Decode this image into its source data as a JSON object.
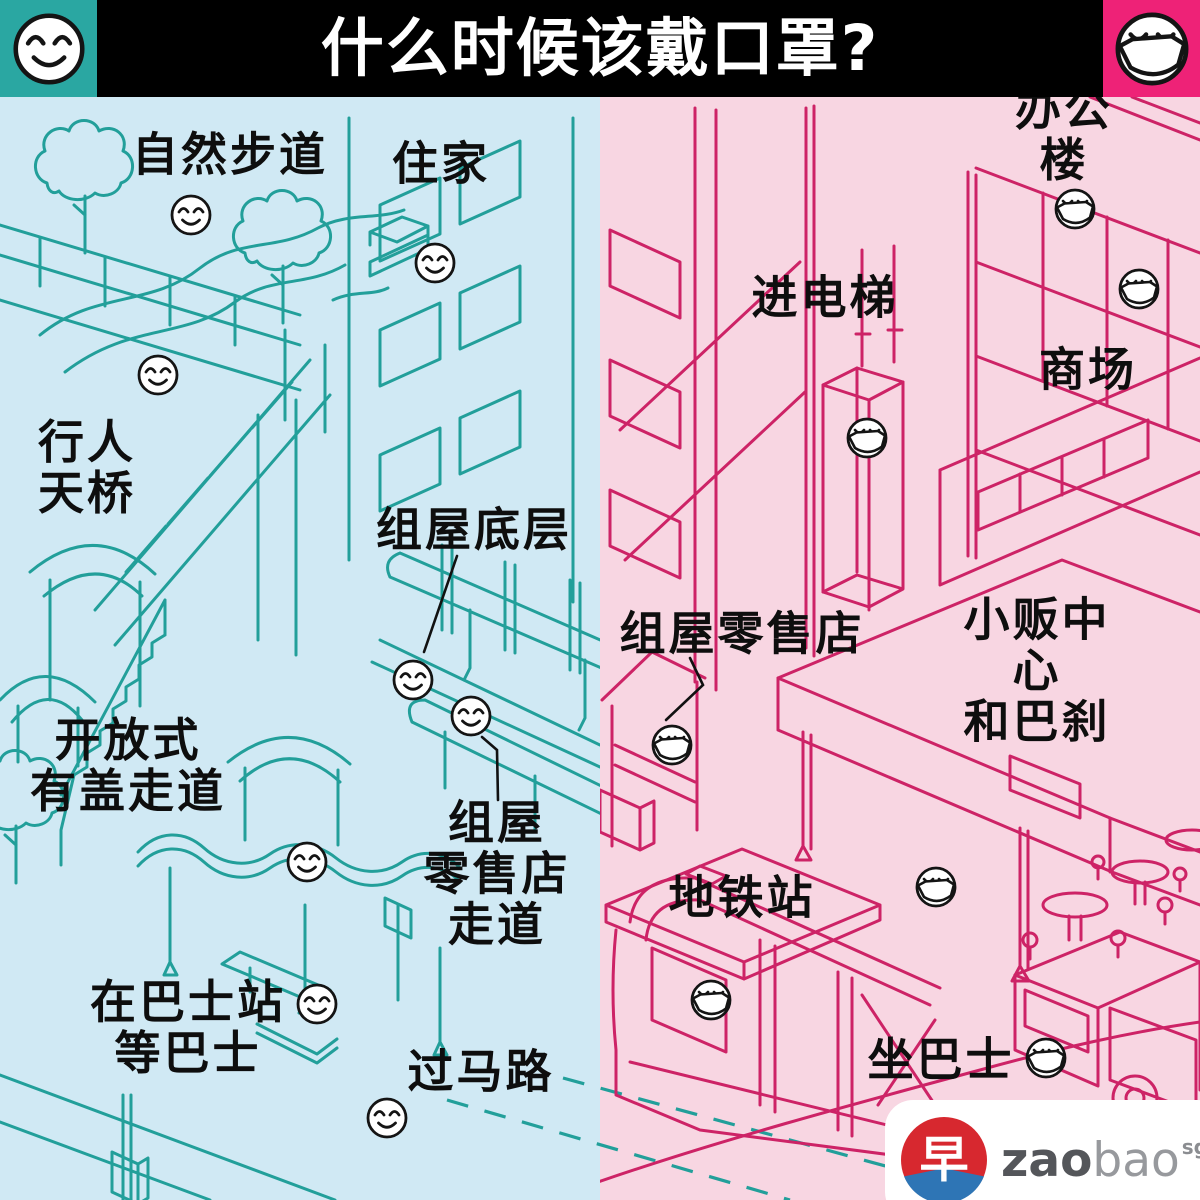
{
  "header": {
    "title": "什么时候该戴口罩?",
    "bar_color": "#000000",
    "left_badge": {
      "icon": "smiley-no-mask-icon",
      "color": "#2aa7a2"
    },
    "right_badge": {
      "icon": "smiley-mask-icon",
      "color": "#ee2277"
    }
  },
  "left_side": {
    "meaning": "no-mask-needed",
    "background": "#d0e9f4",
    "line_color": "#229f9a",
    "face_icon": "smiley-no-mask-icon",
    "face_count": 8,
    "labels": [
      {
        "id": "nature-trail",
        "text": "自然步道"
      },
      {
        "id": "home",
        "text": "住家"
      },
      {
        "id": "pedestrian-bridge",
        "text": "行人\n天桥"
      },
      {
        "id": "hdb-void-deck",
        "text": "组屋底层"
      },
      {
        "id": "open-covered-walkway",
        "text": "开放式\n有盖走道"
      },
      {
        "id": "hdb-shop-walkway",
        "text": "组屋\n零售店\n走道"
      },
      {
        "id": "wait-bus-at-stop",
        "text": "在巴士站\n等巴士"
      },
      {
        "id": "crossing-road",
        "text": "过马路"
      }
    ]
  },
  "right_side": {
    "meaning": "mask-needed",
    "background": "#f8d6e2",
    "line_color": "#cd2366",
    "face_icon": "smiley-mask-icon",
    "face_count": 7,
    "labels": [
      {
        "id": "office-building",
        "text": "办公楼"
      },
      {
        "id": "taking-lift",
        "text": "进电梯"
      },
      {
        "id": "mall",
        "text": "商场"
      },
      {
        "id": "hdb-retail-shop",
        "text": "组屋零售店"
      },
      {
        "id": "hawker-centre-market",
        "text": "小贩中心\n和巴刹"
      },
      {
        "id": "mrt-station",
        "text": "地铁站"
      },
      {
        "id": "taking-bus",
        "text": "坐巴士"
      }
    ]
  },
  "logo": {
    "glyph": "早",
    "zao": "zao",
    "bao": "bao",
    "sg": "sg"
  }
}
